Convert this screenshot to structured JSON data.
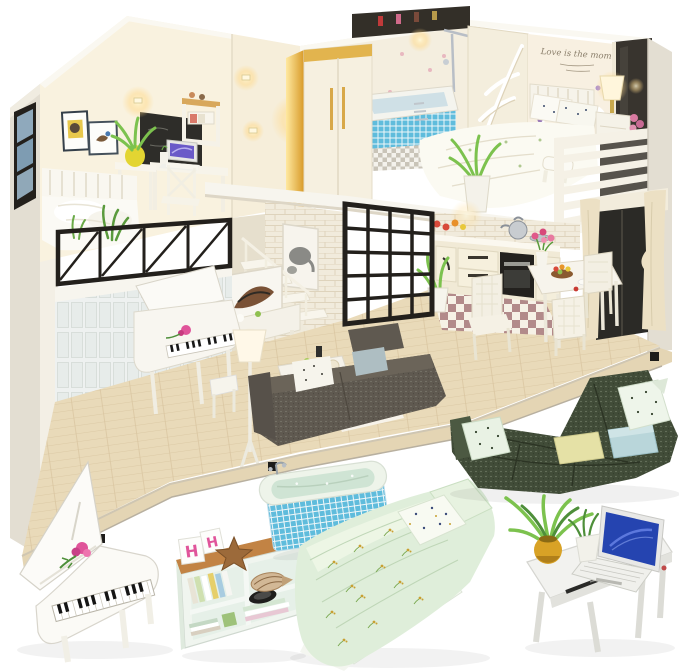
{
  "scene": {
    "type": "product-photo",
    "subject": "DIY miniature dollhouse loft apartment kit with warm LED lighting, shown above six standalone doll furniture pieces on a white background",
    "background": "#ffffff",
    "objects": [
      "dollhouse-loft-diorama",
      "grand-piano",
      "bookshelf-console",
      "mosaic-bathtub",
      "double-bed-mint-bedding",
      "green-sectional-sofa",
      "writing-desk-with-laptop"
    ]
  },
  "texts": {
    "wall_quote": "Love is the moment",
    "block_letters": [
      "H",
      "H"
    ]
  },
  "colors": {
    "bg": "#ffffff",
    "wall_cream": "#f4eedf",
    "wall_warm": "#f9f2df",
    "wall_shadow": "#e6dfcd",
    "exterior": "#e3ded2",
    "roof_light": "#faf8f1",
    "slab_white": "#f7f5ee",
    "glow": "#ffd98a",
    "wood_floor": "#e9dab9",
    "wood_dark": "#d8c29b",
    "base_wood": "#e4d5b4",
    "iron_black": "#23201c",
    "panel_white": "#eef1f0",
    "brick": "#f1ebdc",
    "wardrobe_gold": "#eebb4e",
    "mosaic_blue": "#5fbcdc",
    "tub_mint": "#cfe4d4",
    "mint": "#dfeeda",
    "mint_light": "#edf6e6",
    "sofa_green": "#414c38",
    "sofa_green_light": "#4c5942",
    "sofa_gray": "#5f5950",
    "pillow_yellow": "#e5e1a6",
    "pillow_blue": "#b9d6da",
    "shelf_wood": "#c28344",
    "laptop_blue": "#2544b0",
    "rose_pink": "#e0549a",
    "leaf_green": "#7cc24e",
    "leaf_dark": "#4e8f3a",
    "checker_mauve": "#b28a8a",
    "curtain_cream": "#ece0c4",
    "screen_cream": "#f4eedd",
    "dark_window": "#38342e",
    "pot_yellow": "#d8a226",
    "chalk_dark": "#2e2d29",
    "white_furn": "#f8f6ef"
  },
  "dollhouse": {
    "rooms": [
      {
        "name": "loft-study-bedroom",
        "items": [
          "single-bed",
          "desk-with-laptop",
          "cross-back-chair",
          "wall-shelves",
          "picture-frames",
          "chalkboard",
          "yellow-vase-plant",
          "wall-sconces",
          "black-balcony-railing",
          "balcony-plants"
        ]
      },
      {
        "name": "living-room",
        "items": [
          "white-grand-piano",
          "floor-lamp",
          "gray-fabric-sofa",
          "ottoman",
          "coffee-table",
          "rug",
          "console-table",
          "abstract-art",
          "elephant-art",
          "white-brick-wall",
          "staircase",
          "paneled-wainscot-wall"
        ]
      },
      {
        "name": "kitchen-dining",
        "items": [
          "cream-cabinets",
          "black-oven",
          "silver-kettle",
          "checkerboard-tiles",
          "dining-table",
          "rattan-chairs",
          "fruit-bowl",
          "pink-flower-vase",
          "potted-plant",
          "black-grid-partition"
        ]
      },
      {
        "name": "bathroom",
        "items": [
          "gold-lit-wardrobe",
          "mosaic-bathtub",
          "chrome-shower",
          "leaf-carved-screen",
          "checker-floor",
          "towel-basket"
        ]
      },
      {
        "name": "master-bedroom",
        "items": [
          "double-bed-floral-bedding",
          "slat-headboard",
          "nightstand",
          "glowing-table-lamp",
          "arch-wall-decals",
          "script-wall-quote",
          "white-balcony-railing",
          "dark-window",
          "cream-curtains",
          "potted-plant",
          "white-bench"
        ]
      }
    ]
  },
  "furniture_items": [
    {
      "name": "grand-piano",
      "accent": "#e0549a"
    },
    {
      "name": "bookshelf-console",
      "accent": "#c28344"
    },
    {
      "name": "mosaic-bathtub",
      "accent": "#5fbcdc"
    },
    {
      "name": "double-bed-mint-bedding",
      "accent": "#dfeeda"
    },
    {
      "name": "sectional-sofa",
      "accent": "#414c38"
    },
    {
      "name": "writing-desk-with-laptop",
      "accent": "#2544b0"
    }
  ]
}
